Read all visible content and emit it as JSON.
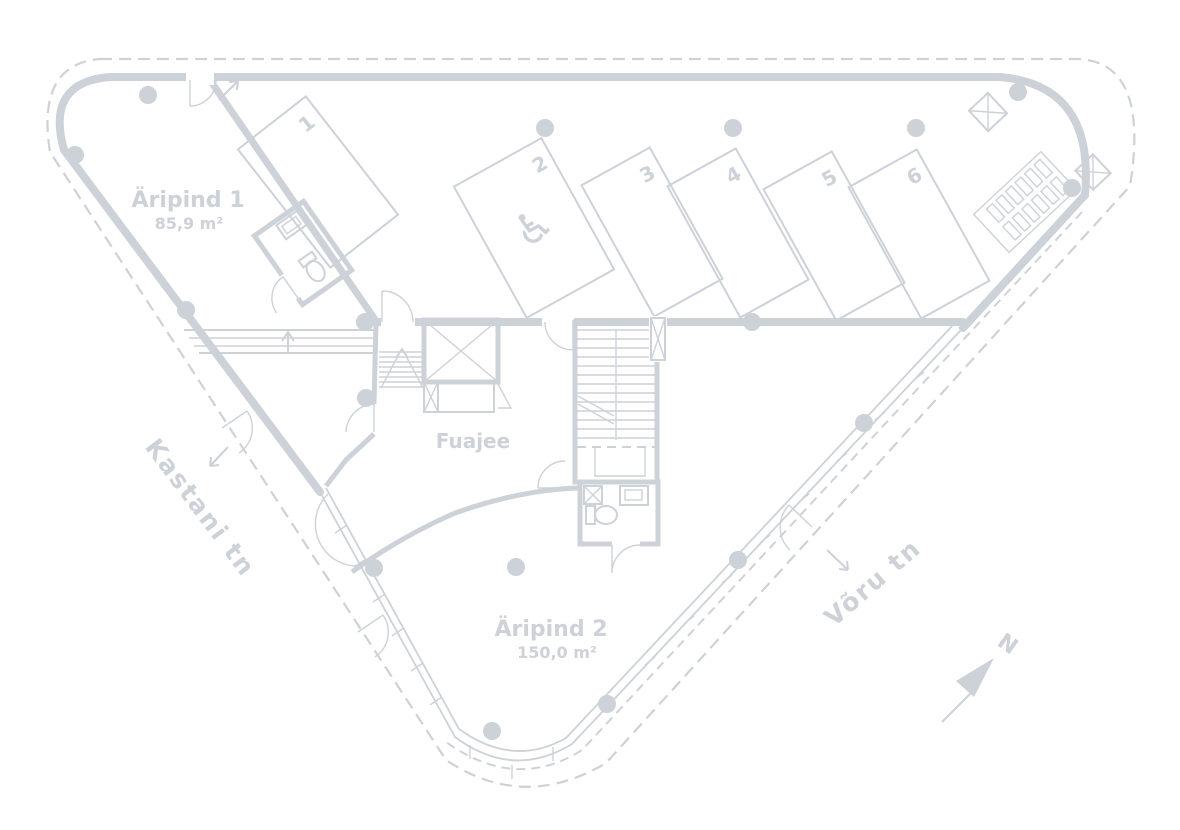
{
  "plan": {
    "rooms": {
      "room1": {
        "name": "Äripind 1",
        "area": "85,9 m²"
      },
      "room2": {
        "name": "Äripind 2",
        "area": "150,0 m²"
      },
      "lobby": {
        "name": "Fuajee"
      }
    },
    "streets": {
      "left": "Kastani tn",
      "right": "Võru tn"
    },
    "compass": {
      "north_label": "N"
    },
    "parking": {
      "spaces": [
        {
          "number": "1"
        },
        {
          "number": "2"
        },
        {
          "number": "3"
        },
        {
          "number": "4"
        },
        {
          "number": "5"
        },
        {
          "number": "6"
        }
      ],
      "accessible_space_number": "2",
      "wheelchair_icon": "♿"
    },
    "colors": {
      "ink": "#cdd1d8",
      "background": "#ffffff"
    }
  }
}
